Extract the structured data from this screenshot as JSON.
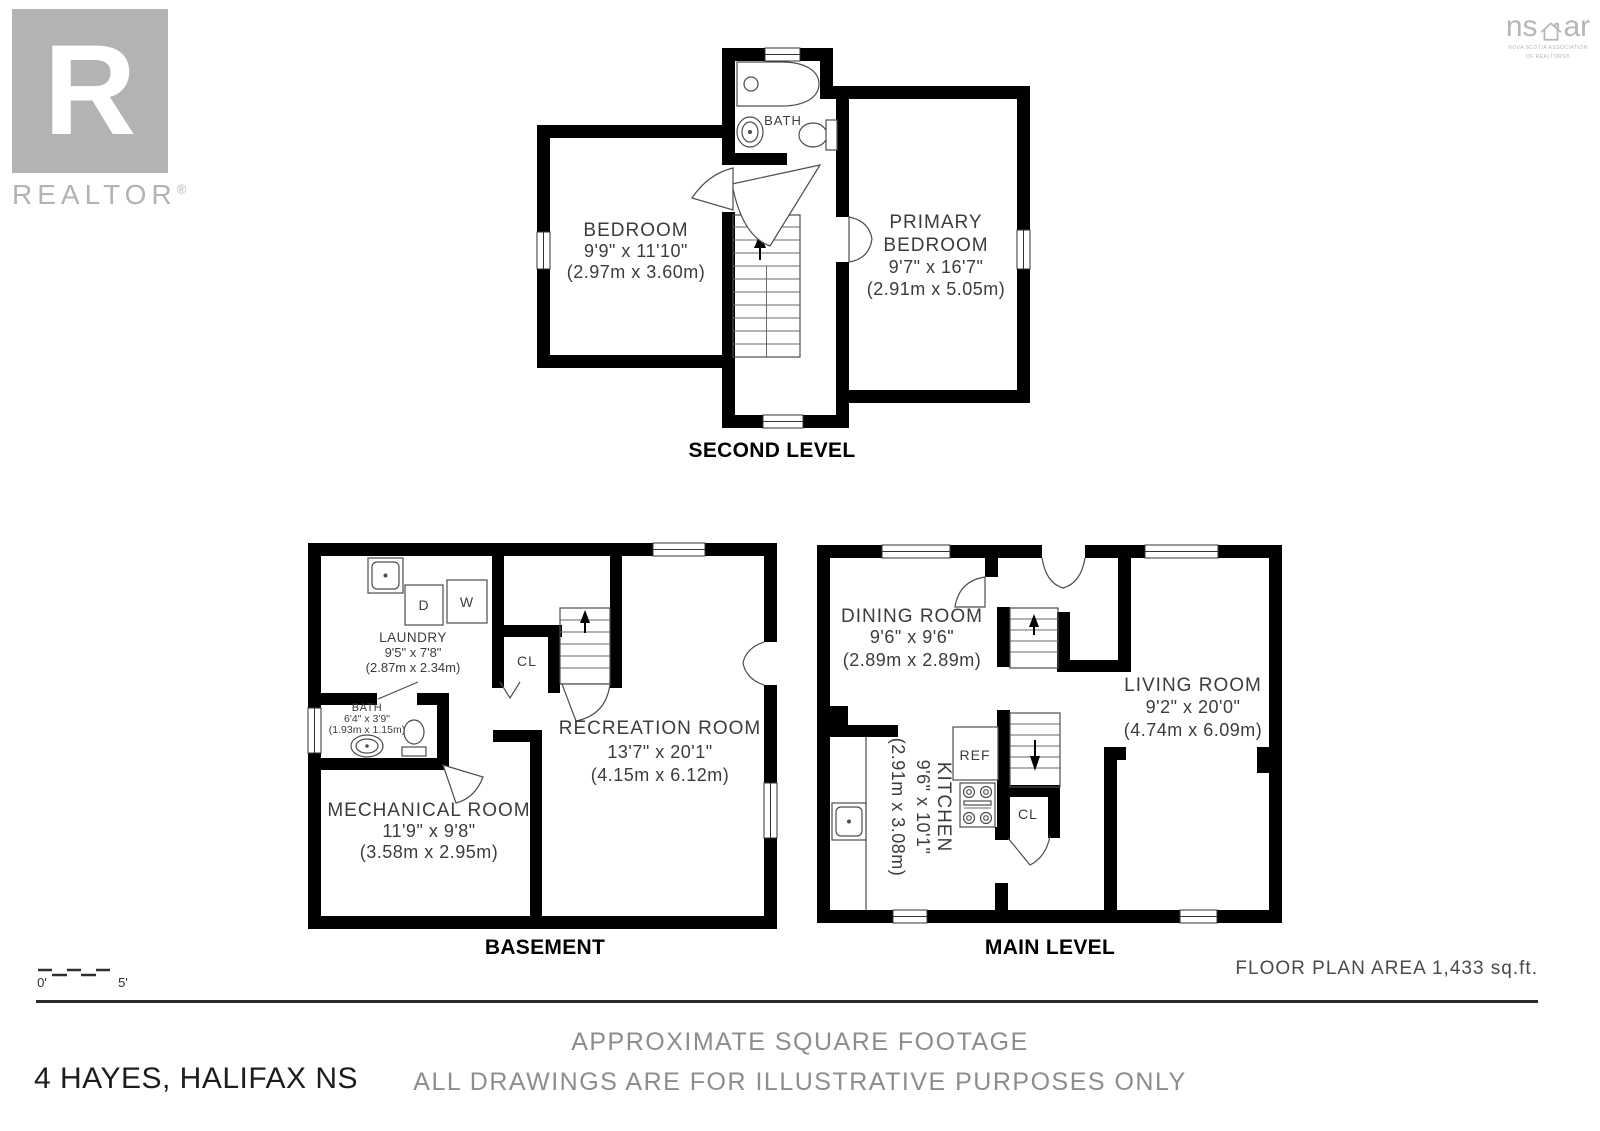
{
  "branding": {
    "realtor": {
      "letter": "R",
      "label": "REALTOR",
      "reg": "®"
    },
    "nsar": {
      "left": "ns",
      "right": "ar",
      "sub1": "NOVA SCOTIA ASSOCIATION",
      "sub2": "OF REALTORS®"
    }
  },
  "plans": {
    "second": {
      "label": "SECOND LEVEL",
      "bedroom": {
        "name": "BEDROOM",
        "imperial": "9'9\" x 11'10\"",
        "metric": "(2.97m x 3.60m)"
      },
      "primary": {
        "line1": "PRIMARY",
        "line2": "BEDROOM",
        "imperial": "9'7\" x 16'7\"",
        "metric": "(2.91m x 5.05m)"
      },
      "bath": {
        "name": "BATH"
      }
    },
    "basement": {
      "label": "BASEMENT",
      "laundry": {
        "name": "LAUNDRY",
        "imperial": "9'5\" x 7'8\"",
        "metric": "(2.87m x 2.34m)"
      },
      "bath": {
        "name": "BATH",
        "imperial": "6'4\" x 3'9\"",
        "metric": "(1.93m x 1.15m)"
      },
      "mechanical": {
        "name": "MECHANICAL ROOM",
        "imperial": "11'9\" x 9'8\"",
        "metric": "(3.58m x 2.95m)"
      },
      "recreation": {
        "name": "RECREATION ROOM",
        "imperial": "13'7\" x 20'1\"",
        "metric": "(4.15m x 6.12m)"
      },
      "closet": "CL",
      "dryer": "D",
      "washer": "W"
    },
    "main": {
      "label": "MAIN LEVEL",
      "dining": {
        "name": "DINING ROOM",
        "imperial": "9'6\" x 9'6\"",
        "metric": "(2.89m x 2.89m)"
      },
      "living": {
        "name": "LIVING ROOM",
        "imperial": "9'2\" x 20'0\"",
        "metric": "(4.74m x 6.09m)"
      },
      "kitchen": {
        "name": "KITCHEN",
        "imperial": "9'6\" x 10'1\"",
        "metric": "(2.91m x 3.08m)"
      },
      "fridge": "REF",
      "closet": "CL"
    }
  },
  "footer": {
    "scale_start": "0'",
    "scale_end": "5'",
    "area": "FLOOR PLAN AREA 1,433 sq.ft.",
    "disclaimer1": "APPROXIMATE SQUARE FOOTAGE",
    "disclaimer2": "ALL DRAWINGS ARE FOR ILLUSTRATIVE PURPOSES ONLY",
    "address": "4 HAYES, HALIFAX NS"
  },
  "colors": {
    "wall": "#000000",
    "accent_gray": "#b4b2b2",
    "text_gray": "#8d8d8d"
  }
}
